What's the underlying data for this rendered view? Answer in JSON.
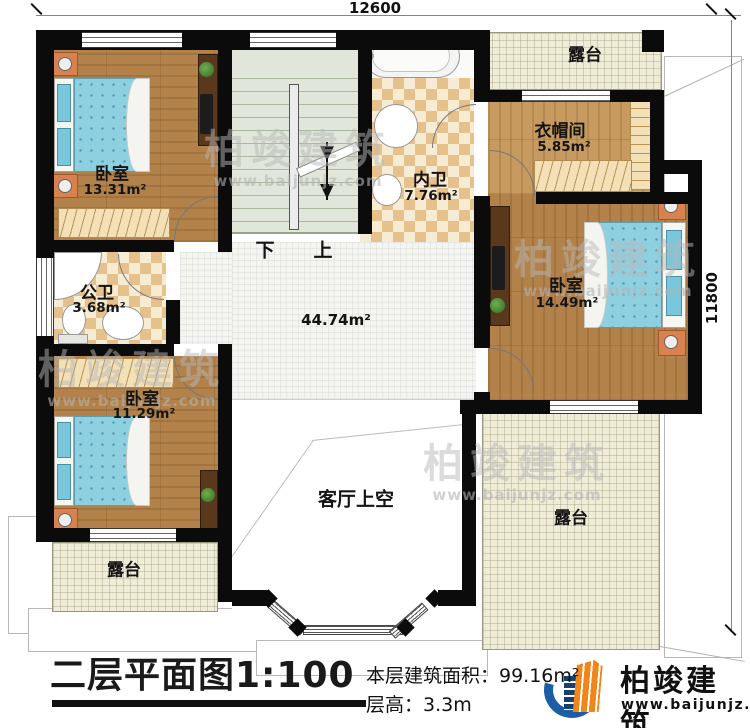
{
  "plan": {
    "dimensions": {
      "top": "12600",
      "right": "11800"
    },
    "rooms": [
      {
        "id": "bedroom-top-left",
        "label": "卧室",
        "area": "13.31m²"
      },
      {
        "id": "ensuite-bath",
        "label": "内卫",
        "area": "7.76m²"
      },
      {
        "id": "cloakroom",
        "label": "衣帽间",
        "area": "5.85m²"
      },
      {
        "id": "bedroom-right",
        "label": "卧室",
        "area": "14.49m²"
      },
      {
        "id": "public-bath",
        "label": "公卫",
        "area": "3.68m²"
      },
      {
        "id": "bedroom-bottom-left",
        "label": "卧室",
        "area": "11.29m²"
      },
      {
        "id": "hall",
        "label": "",
        "area": "44.74m²"
      },
      {
        "id": "living-room-void",
        "label": "客厅上空",
        "area": ""
      },
      {
        "id": "terrace-top",
        "label": "露台",
        "area": ""
      },
      {
        "id": "terrace-bottom-left",
        "label": "露台",
        "area": ""
      },
      {
        "id": "terrace-bottom-right",
        "label": "露台",
        "area": ""
      }
    ],
    "stairs": {
      "down": "下",
      "up": "上"
    }
  },
  "footer": {
    "title": "二层平面图1:100",
    "area_line": "本层建筑面积：99.16m²",
    "height_line": "层高：3.3m"
  },
  "brand": {
    "name": "柏竣建筑",
    "url": "www.baijunjz.com",
    "blue": "#1b5ea6",
    "orange": "#f08519"
  },
  "watermark": {
    "text": "柏竣建筑",
    "url": "www.baijunjz.com"
  },
  "colors": {
    "wall": "#0b0b0b",
    "wood_floor": "#b2824a",
    "bed_blue": "#8ed0e0",
    "terrace_floor": "#efecd8",
    "bath_checker": "#e7c18c",
    "stair_floor": "#e0e6d9"
  }
}
